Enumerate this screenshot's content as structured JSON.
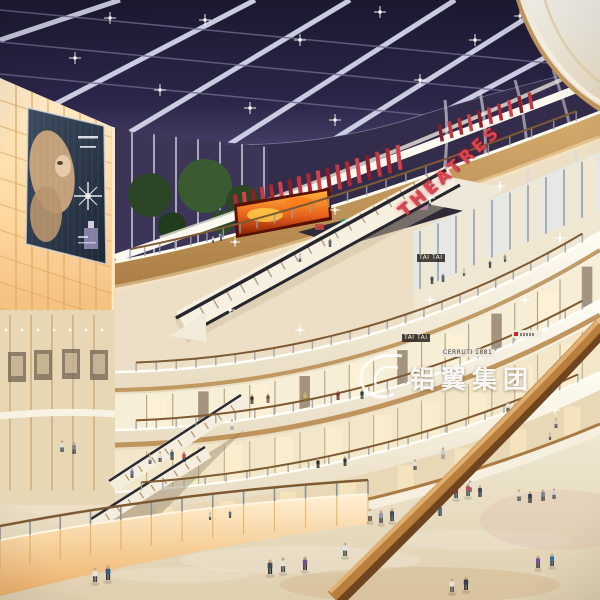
{
  "signs": {
    "theatre": "THEATRES",
    "watermark_cn": "铝翼集团",
    "shop_tai_tai_upper": "TAI TAI",
    "shop_tai_tai_lower": "TAI TAI",
    "shop_cerruti": "CERRUTI 1881"
  },
  "colors": {
    "sky": "#272242",
    "beam": "#d8dbef",
    "theatre_red": "#c02f38",
    "cream": "#f4ecdb",
    "cream_bright": "#fffdf3",
    "wood": "#c79c60",
    "wood_dark": "#8a5e2e",
    "glow": "#ffd9a2",
    "floor": "#e9dfc8",
    "fire_screen": "#e06a1e",
    "glass": "#3d3658"
  }
}
